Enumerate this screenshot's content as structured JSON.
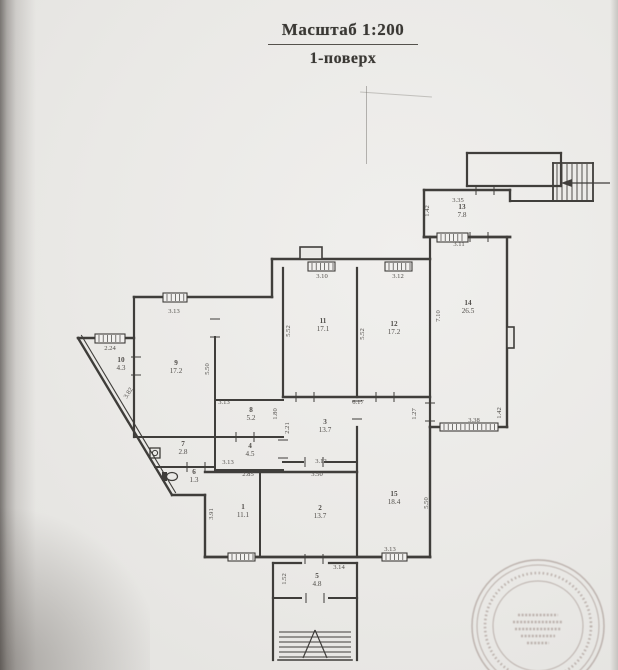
{
  "page": {
    "title_scale": "Масштаб 1:200",
    "title_floor": "1-поверх"
  },
  "colors": {
    "paper": "#eae9e6",
    "ink": "#33312e",
    "dim_text": "#45423e",
    "stamp": "#8f7b74"
  },
  "plan": {
    "rooms": [
      {
        "n": "13",
        "a": "7.8",
        "x": 462,
        "y": 209
      },
      {
        "n": "14",
        "a": "26.5",
        "x": 468,
        "y": 305
      },
      {
        "n": "11",
        "a": "17.1",
        "x": 323,
        "y": 323
      },
      {
        "n": "12",
        "a": "17.2",
        "x": 394,
        "y": 326
      },
      {
        "n": "9",
        "a": "17.2",
        "x": 176,
        "y": 365
      },
      {
        "n": "10",
        "a": "4.3",
        "x": 121,
        "y": 362
      },
      {
        "n": "8",
        "a": "5.2",
        "x": 251,
        "y": 412
      },
      {
        "n": "3",
        "a": "13.7",
        "x": 325,
        "y": 424
      },
      {
        "n": "7",
        "a": "2.8",
        "x": 183,
        "y": 446
      },
      {
        "n": "4",
        "a": "4.5",
        "x": 250,
        "y": 448
      },
      {
        "n": "6",
        "a": "1.3",
        "x": 194,
        "y": 474
      },
      {
        "n": "1",
        "a": "11.1",
        "x": 243,
        "y": 509
      },
      {
        "n": "2",
        "a": "13.7",
        "x": 320,
        "y": 510
      },
      {
        "n": "15",
        "a": "18.4",
        "x": 394,
        "y": 496
      },
      {
        "n": "5",
        "a": "4.8",
        "x": 317,
        "y": 578
      }
    ],
    "dims": [
      {
        "t": "3.35",
        "x": 458,
        "y": 202
      },
      {
        "t": "3.11",
        "x": 459,
        "y": 246
      },
      {
        "t": "3.10",
        "x": 322,
        "y": 278
      },
      {
        "t": "3.12",
        "x": 398,
        "y": 278
      },
      {
        "t": "3.13",
        "x": 174,
        "y": 313
      },
      {
        "t": "2.24",
        "x": 110,
        "y": 350
      },
      {
        "t": "3.13",
        "x": 224,
        "y": 404
      },
      {
        "t": "6.17",
        "x": 358,
        "y": 404
      },
      {
        "t": "3.38",
        "x": 474,
        "y": 422
      },
      {
        "t": "3.13",
        "x": 228,
        "y": 464
      },
      {
        "t": "2.85",
        "x": 248,
        "y": 476
      },
      {
        "t": "3.12",
        "x": 321,
        "y": 463
      },
      {
        "t": "3.50",
        "x": 317,
        "y": 476
      },
      {
        "t": "3.13",
        "x": 390,
        "y": 551
      },
      {
        "t": "3.14",
        "x": 339,
        "y": 569
      },
      {
        "t": "1.42",
        "x": 429,
        "y": 211,
        "r": -90
      },
      {
        "t": "7.10",
        "x": 440,
        "y": 316,
        "r": -90
      },
      {
        "t": "5.52",
        "x": 290,
        "y": 331,
        "r": -90
      },
      {
        "t": "5.52",
        "x": 364,
        "y": 334,
        "r": -90
      },
      {
        "t": "5.50",
        "x": 209,
        "y": 369,
        "r": -90
      },
      {
        "t": "3.82",
        "x": 130,
        "y": 394,
        "r": -58
      },
      {
        "t": "1.80",
        "x": 277,
        "y": 414,
        "r": -90
      },
      {
        "t": "2.21",
        "x": 289,
        "y": 428,
        "r": -90
      },
      {
        "t": "1.27",
        "x": 416,
        "y": 414,
        "r": -90
      },
      {
        "t": "1.42",
        "x": 501,
        "y": 413,
        "r": -90
      },
      {
        "t": "3.91",
        "x": 213,
        "y": 514,
        "r": -90
      },
      {
        "t": "5.50",
        "x": 428,
        "y": 503,
        "r": -90
      },
      {
        "t": "1.52",
        "x": 286,
        "y": 579,
        "r": -90
      }
    ],
    "walls": [
      [
        424,
        190,
        510,
        190,
        2.4
      ],
      [
        424,
        190,
        424,
        237,
        2.4
      ],
      [
        510,
        190,
        510,
        201,
        2.4
      ],
      [
        424,
        237,
        510,
        237,
        2.8
      ],
      [
        430,
        237,
        430,
        427,
        2.2
      ],
      [
        507,
        237,
        507,
        427,
        2.4
      ],
      [
        430,
        427,
        507,
        427,
        2.6
      ],
      [
        272,
        259,
        430,
        259,
        2.6
      ],
      [
        272,
        259,
        272,
        297,
        2.4
      ],
      [
        134,
        297,
        272,
        297,
        2.6
      ],
      [
        134,
        297,
        134,
        437,
        2.2
      ],
      [
        78,
        338,
        134,
        338,
        2.4
      ],
      [
        78,
        338,
        172,
        495,
        2.4
      ],
      [
        81.5,
        335.5,
        175.5,
        492.5,
        1.1
      ],
      [
        172,
        495,
        205,
        495,
        2.4
      ],
      [
        205,
        495,
        205,
        557,
        2.4
      ],
      [
        205,
        557,
        430,
        557,
        2.8
      ],
      [
        430,
        427,
        430,
        557,
        2.4
      ],
      [
        283,
        268,
        283,
        397,
        2.2
      ],
      [
        357,
        268,
        357,
        397,
        2.2
      ],
      [
        215,
        337,
        215,
        470,
        2
      ],
      [
        134,
        437,
        215,
        437,
        2
      ],
      [
        155,
        467,
        215,
        467,
        2
      ],
      [
        215,
        400,
        283,
        400,
        2
      ],
      [
        215,
        437,
        283,
        437,
        2
      ],
      [
        215,
        470,
        283,
        470,
        2
      ],
      [
        205,
        472,
        357,
        472,
        2.4
      ],
      [
        283,
        462,
        303,
        462,
        2
      ],
      [
        325,
        462,
        357,
        462,
        2
      ],
      [
        260,
        472,
        260,
        557,
        2
      ],
      [
        357,
        427,
        357,
        557,
        2.2
      ],
      [
        283,
        397,
        430,
        397,
        2.4
      ],
      [
        273,
        563,
        273,
        598,
        2.2
      ],
      [
        357,
        563,
        357,
        598,
        2.2
      ],
      [
        273,
        563,
        301,
        563,
        2.2
      ],
      [
        329,
        563,
        357,
        563,
        2.2
      ],
      [
        273,
        598,
        301,
        598,
        2
      ],
      [
        329,
        598,
        357,
        598,
        2
      ],
      [
        273,
        598,
        273,
        660,
        2.2
      ],
      [
        357,
        598,
        357,
        660,
        2.2
      ],
      [
        278,
        660,
        352,
        660,
        1.6
      ],
      [
        467,
        153,
        561,
        153,
        2.2
      ],
      [
        467,
        153,
        467,
        186,
        2.2
      ],
      [
        467,
        186,
        561,
        186,
        2.2
      ],
      [
        561,
        153,
        561,
        186,
        2.2
      ],
      [
        510,
        201,
        593,
        201,
        2
      ],
      [
        553,
        163,
        593,
        163,
        1.8
      ],
      [
        553,
        163,
        553,
        201,
        1.8
      ],
      [
        593,
        163,
        593,
        201,
        1.8
      ]
    ],
    "rects": [
      {
        "x": 300,
        "y": 247,
        "w": 22,
        "h": 12
      },
      {
        "x": 507,
        "y": 327,
        "w": 7,
        "h": 21
      }
    ],
    "windows": [
      {
        "x": 308,
        "y": 262,
        "w": 27,
        "h": 9
      },
      {
        "x": 385,
        "y": 262,
        "w": 27,
        "h": 9
      },
      {
        "x": 163,
        "y": 293,
        "w": 24,
        "h": 9
      },
      {
        "x": 95,
        "y": 334,
        "w": 30,
        "h": 9
      },
      {
        "x": 437,
        "y": 233,
        "w": 31,
        "h": 9
      },
      {
        "x": 440,
        "y": 423,
        "w": 58,
        "h": 8
      },
      {
        "x": 228,
        "y": 553,
        "w": 27,
        "h": 8
      },
      {
        "x": 382,
        "y": 553,
        "w": 25,
        "h": 8
      }
    ],
    "doors": [
      {
        "x": 485,
        "y": 190,
        "o": "h"
      },
      {
        "x": 479,
        "y": 237,
        "o": "h"
      },
      {
        "x": 215,
        "y": 328,
        "o": "v"
      },
      {
        "x": 136,
        "y": 366,
        "o": "v"
      },
      {
        "x": 305,
        "y": 397,
        "o": "h"
      },
      {
        "x": 385,
        "y": 397,
        "o": "h"
      },
      {
        "x": 430,
        "y": 412,
        "o": "v"
      },
      {
        "x": 283,
        "y": 449,
        "o": "v"
      },
      {
        "x": 245,
        "y": 437,
        "o": "h"
      },
      {
        "x": 196,
        "y": 467,
        "o": "h"
      },
      {
        "x": 357,
        "y": 410,
        "o": "v"
      },
      {
        "x": 314,
        "y": 559,
        "o": "h"
      },
      {
        "x": 315,
        "y": 598,
        "o": "h"
      },
      {
        "x": 314,
        "y": 462,
        "o": "h"
      }
    ],
    "fixtures": [
      {
        "type": "sink",
        "x": 150,
        "y": 448,
        "w": 10,
        "h": 10
      },
      {
        "type": "wc",
        "x": 162,
        "y": 472,
        "w": 16,
        "h": 11
      }
    ],
    "stairs_top": {
      "lines_x": [
        557,
        562,
        567,
        572,
        577,
        582,
        587
      ],
      "y1": 164,
      "y2": 200,
      "arrow": {
        "x1": 610,
        "y1": 183,
        "x2": 570,
        "y2": 183,
        "head": [
          [
            561,
            183
          ],
          [
            572,
            179
          ],
          [
            572,
            187
          ]
        ]
      }
    },
    "stairs_bottom": {
      "steps_y": [
        632,
        637,
        642,
        647,
        652,
        657
      ],
      "x1": 279,
      "x2": 351,
      "arrow": {
        "apex": [
          315,
          630
        ],
        "legs": [
          [
            303,
            658
          ],
          [
            327,
            658
          ]
        ]
      }
    },
    "stamp": {
      "cx": 538,
      "cy": 626,
      "r1": 66,
      "r2": 61,
      "r3": 45,
      "legible": false
    }
  }
}
